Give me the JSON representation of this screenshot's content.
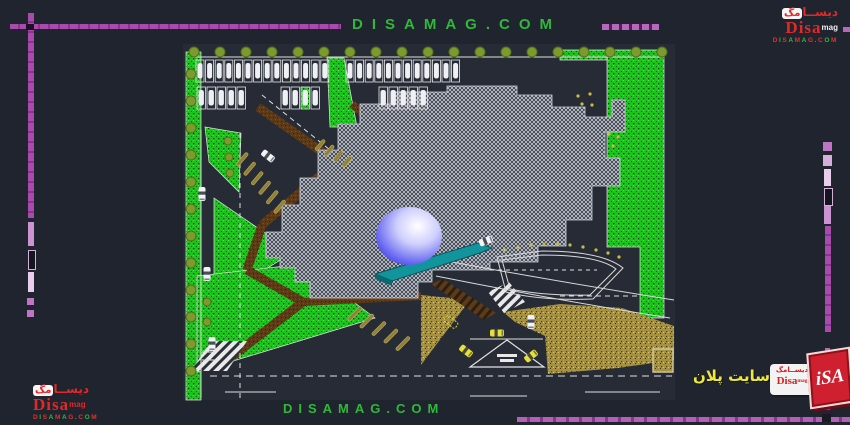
{
  "watermark_top": "DISAMAG.COM",
  "watermark_bottom": "DISAMAG.COM",
  "site_label": "سایت پلان",
  "logos": {
    "brand_fa_rest": "دیســا",
    "brand_fa_chip": "مگ",
    "brand_fa": "دیســامگ",
    "brand_en": "Disa",
    "brand_suffix": "mag",
    "brand_url": "DISAMAG.COM",
    "cube_text": "iSA"
  },
  "colors": {
    "accent_green": "#2fb83a",
    "accent_purple": "#a74bad",
    "logo_red": "#e22828",
    "label_yellow": "#efe838",
    "grass": "#1ec41e",
    "sand": "#a59140",
    "hatch_gray": "#c3c7d1",
    "sphere_blue": "#2424d8",
    "teal": "#12949c",
    "path_brown": "#5e3a17"
  },
  "site_plan": {
    "greens": [
      {
        "pts": "186,52 201,52 201,400 186,400"
      },
      {
        "pts": "327,58 344,58 357,127 330,127"
      },
      {
        "pts": "205,127 241,133 239,192 209,162"
      },
      {
        "pts": "214,198 293,252 214,302"
      },
      {
        "pts": "197,276 303,264 375,318 197,372"
      },
      {
        "pts": "607,50 664,50 664,318 640,318 640,247 607,247"
      },
      {
        "pts": "560,50 607,50 607,60 560,60"
      }
    ],
    "sands": [
      {
        "pts": "421,295 470,300 436,345 421,365"
      },
      {
        "pts": "503,312 560,304 622,308 674,326 674,360 618,368 548,374 545,336 515,322"
      },
      {
        "pts": "653,349 673,349 673,372 653,372",
        "framed": true
      }
    ],
    "building": {
      "pts": "266,248 266,232 282,232 282,205 300,205 300,178 318,178 318,150 338,150 338,124 360,124 360,104 395,104 395,92 447,92 447,86 517,86 517,95 552,95 552,107 585,107 585,117 612,117 612,100 625,100 625,132 605,132 605,158 620,158 620,186 592,186 592,220 566,220 566,246 538,246 538,262 490,262 490,270 432,270 432,282 418,282 418,298 310,298 310,282 295,282 295,268 280,268 280,258 266,258"
    },
    "sphere": {
      "cx": 409,
      "cy": 236,
      "rx": 33,
      "ry": 29
    },
    "teal": {
      "pts": "375,274 478,243 492,248 480,253 392,281",
      "pts2": "375,274 392,281 392,286 375,279"
    },
    "brown_paths": [
      {
        "x1": 258,
        "y1": 107,
        "x2": 338,
        "y2": 163,
        "w": 9
      },
      {
        "x1": 352,
        "y1": 104,
        "x2": 416,
        "y2": 160,
        "w": 8
      },
      {
        "x1": 336,
        "y1": 162,
        "x2": 262,
        "y2": 225,
        "w": 9
      },
      {
        "x1": 262,
        "y1": 225,
        "x2": 247,
        "y2": 270,
        "w": 9
      },
      {
        "x1": 247,
        "y1": 270,
        "x2": 303,
        "y2": 302,
        "w": 9
      },
      {
        "x1": 303,
        "y1": 302,
        "x2": 421,
        "y2": 296,
        "w": 8
      },
      {
        "x1": 303,
        "y1": 302,
        "x2": 230,
        "y2": 358,
        "w": 9
      }
    ],
    "crosswalks": [
      {
        "pts": "431,284 443,279 496,313 484,320",
        "type": "brown"
      },
      {
        "pts": "488,292 509,282 525,302 504,313",
        "type": "white"
      },
      {
        "pts": "211,341 247,341 227,371 191,371",
        "type": "white"
      }
    ],
    "white_lines": [
      {
        "x1": 192,
        "y1": 57,
        "x2": 663,
        "y2": 57
      },
      {
        "x1": 201,
        "y1": 130,
        "x2": 201,
        "y2": 398
      },
      {
        "x1": 240,
        "y1": 133,
        "x2": 240,
        "y2": 398,
        "dash": "5,5"
      },
      {
        "x1": 262,
        "y1": 95,
        "x2": 330,
        "y2": 150,
        "dash": "5,4"
      },
      {
        "x1": 210,
        "y1": 376,
        "x2": 672,
        "y2": 376,
        "dash": "7,5"
      },
      {
        "x1": 225,
        "y1": 392,
        "x2": 276,
        "y2": 392
      },
      {
        "x1": 470,
        "y1": 396,
        "x2": 527,
        "y2": 396
      },
      {
        "x1": 585,
        "y1": 392,
        "x2": 660,
        "y2": 392
      },
      {
        "x1": 490,
        "y1": 270,
        "x2": 597,
        "y2": 270,
        "dash": "4,4"
      },
      {
        "x1": 560,
        "y1": 296,
        "x2": 641,
        "y2": 296,
        "dash": "5,4"
      },
      {
        "x1": 202,
        "y1": 352,
        "x2": 216,
        "y2": 352
      },
      {
        "x1": 202,
        "y1": 360,
        "x2": 216,
        "y2": 360
      },
      {
        "x1": 470,
        "y1": 339,
        "x2": 543,
        "y2": 339
      }
    ],
    "curves": [
      {
        "d": "M452,262 Q560,282 674,300"
      },
      {
        "d": "M436,276 Q556,300 670,318"
      },
      {
        "d": "M497,257 L542,251 Q602,251 623,268 L593,299 Q542,301 506,292 Z"
      },
      {
        "d": "M502,260 L542,255 Q598,255 616,269 L590,295 Q544,296 510,289 Z"
      }
    ],
    "triangle": {
      "pts": "507,340 544,367 470,367",
      "marks": [
        [
          497,
          354,
          20,
          3
        ],
        [
          500,
          359,
          14,
          3
        ]
      ]
    },
    "stall_groups": [
      {
        "x": 196,
        "y": 60,
        "n": 14,
        "dx": 9.6
      },
      {
        "x": 346,
        "y": 60,
        "n": 12,
        "dx": 9.6
      },
      {
        "x": 197,
        "y": 87,
        "n": 5,
        "dx": 10
      },
      {
        "x": 281,
        "y": 87,
        "n": 4,
        "dx": 10,
        "green": 2
      },
      {
        "x": 379,
        "y": 87,
        "n": 5,
        "dx": 10
      }
    ],
    "angled_stalls": [
      {
        "x": 246,
        "y": 152,
        "n": 6,
        "dx": 7.5,
        "dy": 9.5,
        "len": 16,
        "rot": 40
      },
      {
        "x": 323,
        "y": 139,
        "n": 4,
        "dx": 9,
        "dy": 5.5,
        "len": 13,
        "rot": 40
      },
      {
        "x": 360,
        "y": 306,
        "n": 5,
        "dx": 12,
        "dy": 7.5,
        "len": 18,
        "rot": 45
      }
    ],
    "tree_rows": [
      {
        "x": 194,
        "y": 52,
        "n": 19,
        "dx": 26,
        "dy": 0,
        "r": 5
      },
      {
        "x": 191,
        "y": 74,
        "n": 12,
        "dx": 0,
        "dy": 27,
        "r": 5
      },
      {
        "x": 228,
        "y": 141,
        "n": 3,
        "dx": 1,
        "dy": 16,
        "r": 4
      },
      {
        "x": 207,
        "y": 302,
        "n": 2,
        "dx": 0,
        "dy": 20,
        "r": 4
      }
    ],
    "dots": [
      [
        578,
        96
      ],
      [
        590,
        94
      ],
      [
        592,
        105
      ],
      [
        582,
        104
      ],
      [
        609,
        134
      ],
      [
        618,
        137
      ],
      [
        613,
        146
      ],
      [
        505,
        250
      ],
      [
        518,
        247
      ],
      [
        531,
        245
      ],
      [
        544,
        244
      ],
      [
        557,
        244
      ],
      [
        570,
        245
      ],
      [
        583,
        247
      ],
      [
        596,
        250
      ],
      [
        608,
        253
      ],
      [
        619,
        257
      ]
    ],
    "cars": [
      {
        "x": 268,
        "y": 156,
        "rot": 38,
        "color": "white"
      },
      {
        "x": 202,
        "y": 194,
        "rot": 90,
        "color": "white"
      },
      {
        "x": 207,
        "y": 274,
        "rot": 90,
        "color": "white"
      },
      {
        "x": 212,
        "y": 344,
        "rot": 90,
        "color": "white"
      },
      {
        "x": 486,
        "y": 241,
        "rot": -22,
        "color": "white"
      },
      {
        "x": 531,
        "y": 322,
        "rot": 90,
        "color": "white"
      },
      {
        "x": 497,
        "y": 333,
        "rot": 0,
        "color": "yellow"
      },
      {
        "x": 466,
        "y": 351,
        "rot": 38,
        "color": "yellow"
      },
      {
        "x": 531,
        "y": 356,
        "rot": -38,
        "color": "yellow"
      },
      {
        "x": 451,
        "y": 322,
        "rot": 38,
        "color": "ghost"
      }
    ]
  }
}
